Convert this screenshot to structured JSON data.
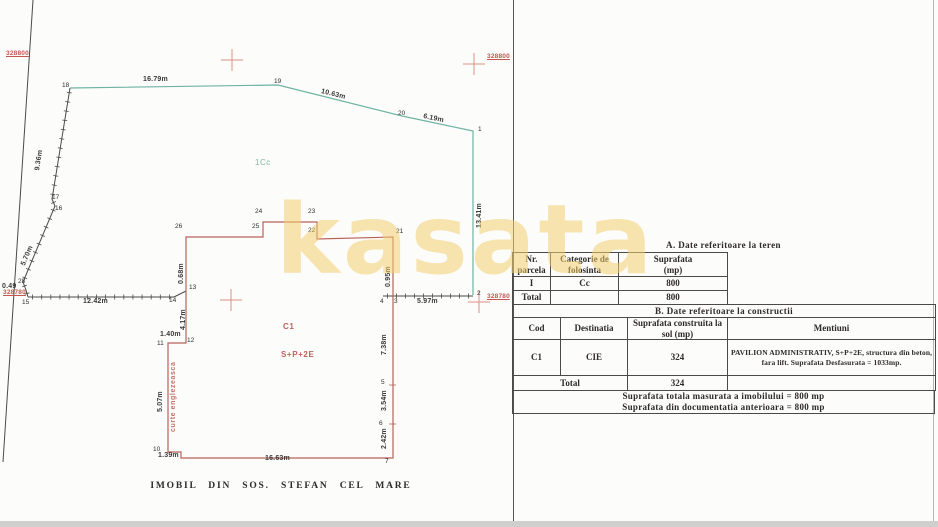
{
  "page": {
    "caption": "IMOBIL DIN SOS. STEFAN CEL MARE",
    "watermark": "kasata"
  },
  "colors": {
    "teal": "#6fb3a4",
    "red": "#b9625a",
    "line": "#4a4a4a",
    "cross": "#de8f87"
  },
  "drawing": {
    "labels": [
      {
        "t": "18",
        "x": 62,
        "y": 82,
        "k": "pt"
      },
      {
        "t": "19",
        "x": 274,
        "y": 78,
        "k": "pt"
      },
      {
        "t": "20",
        "x": 398,
        "y": 110,
        "k": "pt"
      },
      {
        "t": "1",
        "x": 478,
        "y": 126,
        "k": "pt"
      },
      {
        "t": "2",
        "x": 477,
        "y": 290,
        "k": "pt"
      },
      {
        "t": "3",
        "x": 394,
        "y": 298,
        "k": "pt"
      },
      {
        "t": "4",
        "x": 380,
        "y": 298,
        "k": "pt"
      },
      {
        "t": "5",
        "x": 381,
        "y": 379,
        "k": "pt"
      },
      {
        "t": "6",
        "x": 379,
        "y": 420,
        "k": "pt"
      },
      {
        "t": "7",
        "x": 385,
        "y": 458,
        "k": "pt"
      },
      {
        "t": "10",
        "x": 153,
        "y": 446,
        "k": "pt"
      },
      {
        "t": "11",
        "x": 157,
        "y": 340,
        "k": "pt"
      },
      {
        "t": "12",
        "x": 187,
        "y": 337,
        "k": "pt"
      },
      {
        "t": "13",
        "x": 189,
        "y": 284,
        "k": "pt"
      },
      {
        "t": "14",
        "x": 169,
        "y": 297,
        "k": "pt"
      },
      {
        "t": "15",
        "x": 22,
        "y": 299,
        "k": "pt"
      },
      {
        "t": "16",
        "x": 55,
        "y": 205,
        "k": "pt"
      },
      {
        "t": "17",
        "x": 52,
        "y": 194,
        "k": "pt"
      },
      {
        "t": "28",
        "x": 18,
        "y": 278,
        "k": "pt"
      },
      {
        "t": "21",
        "x": 396,
        "y": 228,
        "k": "pt"
      },
      {
        "t": "22",
        "x": 308,
        "y": 227,
        "k": "pt"
      },
      {
        "t": "23",
        "x": 308,
        "y": 208,
        "k": "pt"
      },
      {
        "t": "24",
        "x": 255,
        "y": 208,
        "k": "pt"
      },
      {
        "t": "25",
        "x": 252,
        "y": 223,
        "k": "pt"
      },
      {
        "t": "26",
        "x": 175,
        "y": 223,
        "k": "pt"
      },
      {
        "t": "16.79m",
        "x": 143,
        "y": 76,
        "k": "dim"
      },
      {
        "t": "10.63m",
        "x": 322,
        "y": 88,
        "r": 14,
        "k": "dim"
      },
      {
        "t": "6.19m",
        "x": 424,
        "y": 113,
        "r": 12,
        "k": "dim"
      },
      {
        "t": "13.41m",
        "x": 476,
        "y": 228,
        "r": -90,
        "k": "dim"
      },
      {
        "t": "9.36m",
        "x": 34,
        "y": 170,
        "r": -81,
        "k": "dim"
      },
      {
        "t": "5.70m",
        "x": 20,
        "y": 264,
        "r": -67,
        "k": "dim"
      },
      {
        "t": "0.49",
        "x": 2,
        "y": 283,
        "k": "dim"
      },
      {
        "t": "12.42m",
        "x": 83,
        "y": 298,
        "k": "dim"
      },
      {
        "t": "0.68m",
        "x": 178,
        "y": 284,
        "r": -90,
        "k": "dim"
      },
      {
        "t": "4.17m",
        "x": 180,
        "y": 330,
        "r": -90,
        "k": "dim"
      },
      {
        "t": "1.40m",
        "x": 160,
        "y": 331,
        "k": "dim"
      },
      {
        "t": "5.07m",
        "x": 157,
        "y": 412,
        "r": -90,
        "k": "dim"
      },
      {
        "t": "1.39m",
        "x": 158,
        "y": 452,
        "k": "dim"
      },
      {
        "t": "16.63m",
        "x": 265,
        "y": 455,
        "k": "dim"
      },
      {
        "t": "2.42m",
        "x": 381,
        "y": 449,
        "r": -90,
        "k": "dim"
      },
      {
        "t": "3.54m",
        "x": 381,
        "y": 411,
        "r": -90,
        "k": "dim"
      },
      {
        "t": "7.38m",
        "x": 381,
        "y": 355,
        "r": -90,
        "k": "dim"
      },
      {
        "t": "0.95m",
        "x": 385,
        "y": 287,
        "r": -90,
        "k": "dim"
      },
      {
        "t": "5.97m",
        "x": 417,
        "y": 298,
        "k": "dim"
      },
      {
        "t": "328800",
        "x": 6,
        "y": 50,
        "k": "coord"
      },
      {
        "t": "328800",
        "x": 487,
        "y": 53,
        "k": "coord"
      },
      {
        "t": "328780",
        "x": 3,
        "y": 289,
        "k": "coord"
      },
      {
        "t": "328780",
        "x": 487,
        "y": 293,
        "k": "coord"
      },
      {
        "t": "1Cc",
        "x": 255,
        "y": 158,
        "k": "zone"
      },
      {
        "t": "C1",
        "x": 283,
        "y": 322,
        "k": "bld"
      },
      {
        "t": "S+P+2E",
        "x": 281,
        "y": 350,
        "k": "bld"
      },
      {
        "t": "curte englezeasca",
        "x": 170,
        "y": 432,
        "r": -90,
        "k": "curte"
      }
    ],
    "geometry": {
      "teal_boundary": [
        [
          70,
          88
        ],
        [
          278,
          85
        ],
        [
          402,
          116
        ],
        [
          473,
          131
        ],
        [
          473,
          295
        ]
      ],
      "hatched": [
        [
          [
            70,
            88
          ],
          [
            52,
            199
          ],
          [
            55,
            206
          ],
          [
            23,
            282
          ],
          [
            26,
            290
          ],
          [
            28,
            297
          ]
        ],
        [
          [
            28,
            297
          ],
          [
            174,
            297
          ]
        ],
        [
          [
            383,
            296
          ],
          [
            473,
            296
          ]
        ]
      ],
      "plain_lines": [
        [
          [
            174,
            297
          ],
          [
            186,
            291
          ]
        ],
        [
          [
            33,
            0
          ],
          [
            3,
            462
          ]
        ]
      ],
      "building_path": "M186,237 L263,237 L263,222 L317,222 L317,239 L393,237 L393,458 L181,458 L181,452 L168,452 L168,343 L186,343 L186,291 Z",
      "building_ticks": [
        [
          [
            389,
            385
          ],
          [
            396,
            385
          ]
        ],
        [
          [
            389,
            424
          ],
          [
            396,
            424
          ]
        ]
      ],
      "crosses": [
        [
          232,
          60
        ],
        [
          474,
          64
        ],
        [
          231,
          300
        ],
        [
          479,
          302
        ]
      ]
    }
  },
  "tables": {
    "a": {
      "title": "A. Date referitoare la teren",
      "headers": [
        [
          "Nr.",
          "parcela"
        ],
        [
          "Categorie de",
          "folosinta"
        ],
        [
          "Suprafata",
          "(mp)"
        ]
      ],
      "rows": [
        [
          "I",
          "Cc",
          "800"
        ],
        [
          "Total",
          "",
          "800"
        ]
      ]
    },
    "b": {
      "title": "B. Date referitoare la constructii",
      "headers": [
        [
          "Cod"
        ],
        [
          "Destinatia"
        ],
        [
          "Suprafata construita la",
          "sol (mp)"
        ],
        [
          "Mentiuni"
        ]
      ],
      "row": [
        "C1",
        "CIE",
        "324",
        "PAVILION ADMINISTRATIV, S+P+2E, structura din beton, fara lift. Suprafata Desfasurata = 1033mp."
      ],
      "total_label": "Total",
      "total_value": "324",
      "total_mentiuni": ""
    },
    "summary": [
      "Suprafata totala masurata a imobilului = 800 mp",
      "Suprafata din documentatia anterioara = 800 mp"
    ]
  }
}
